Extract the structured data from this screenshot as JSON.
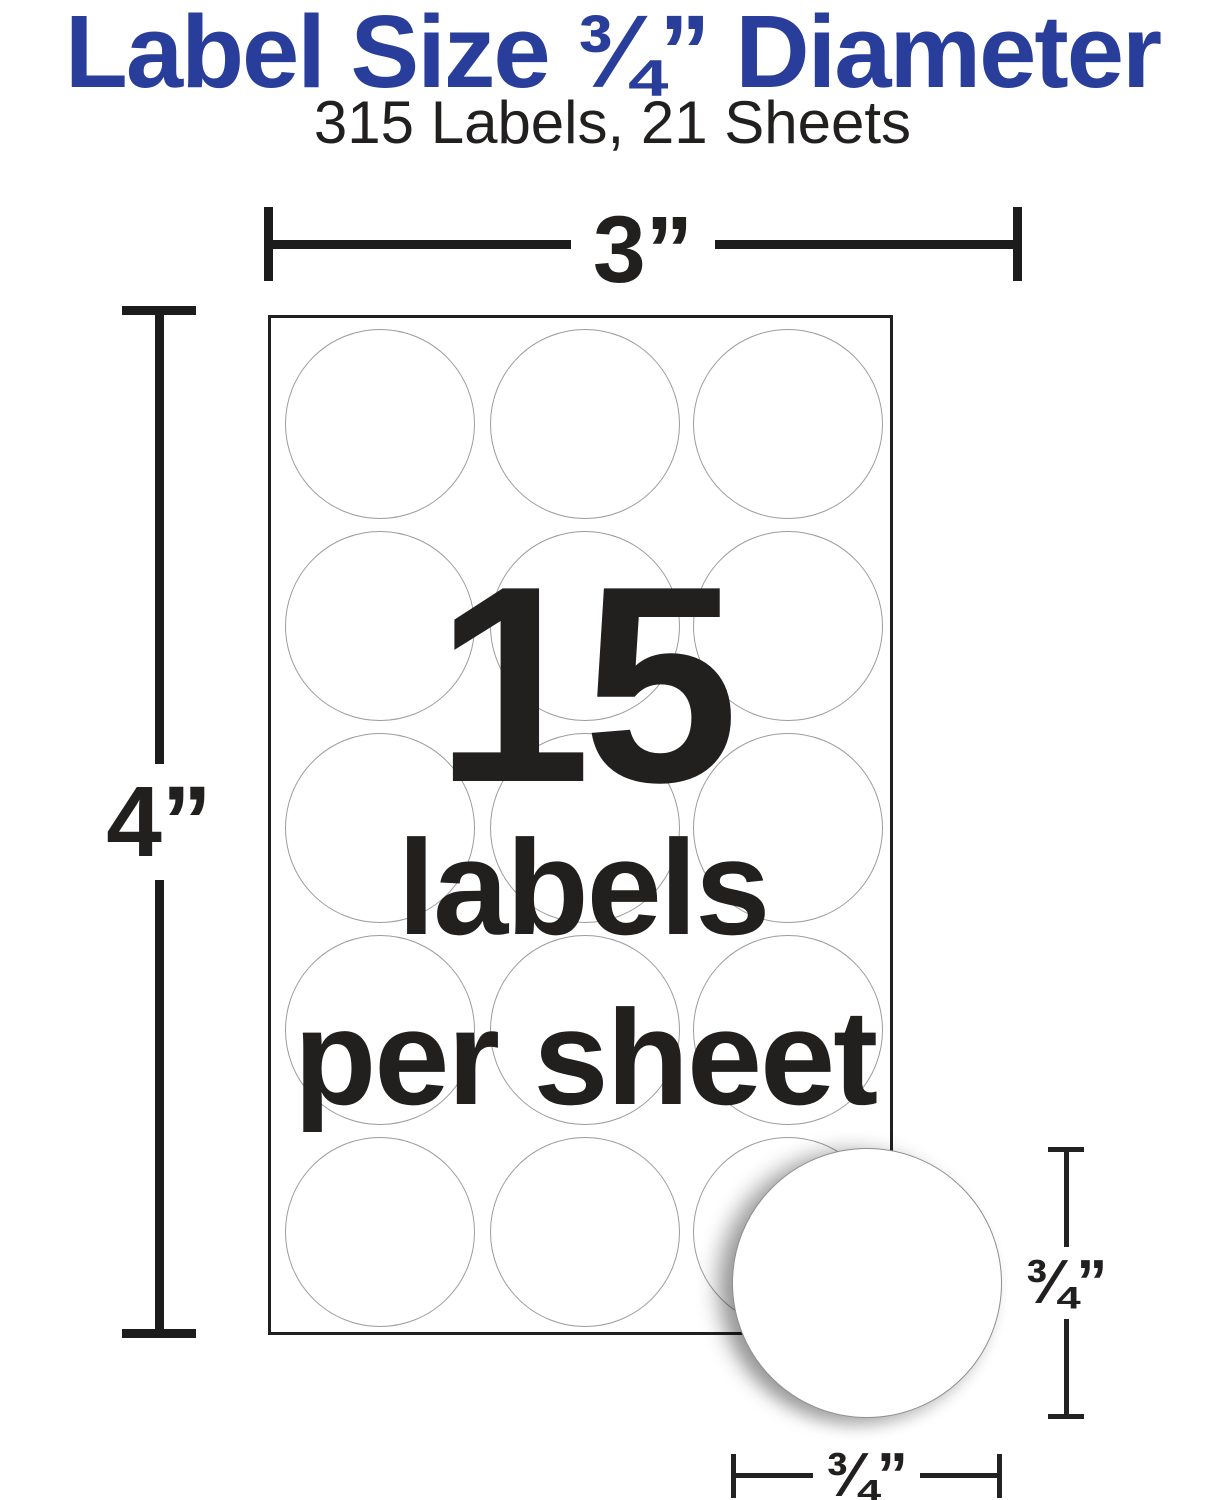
{
  "title": {
    "text": "Label Size ¾” Diameter",
    "color": "#293e9b"
  },
  "subtitle": {
    "text": "315 Labels, 21 Sheets"
  },
  "dimensions": {
    "sheet_width_label": "3”",
    "sheet_height_label": "4”",
    "label_height_label": "¾”",
    "label_width_label": "¾”"
  },
  "sheet": {
    "rows": 5,
    "cols": 3,
    "big_number": "15",
    "caption_line1": "labels",
    "caption_line2": "per sheet"
  },
  "colors": {
    "accent_blue": "#293e9b",
    "ink": "#221f1f",
    "circle_outline": "#9c9c9c"
  }
}
